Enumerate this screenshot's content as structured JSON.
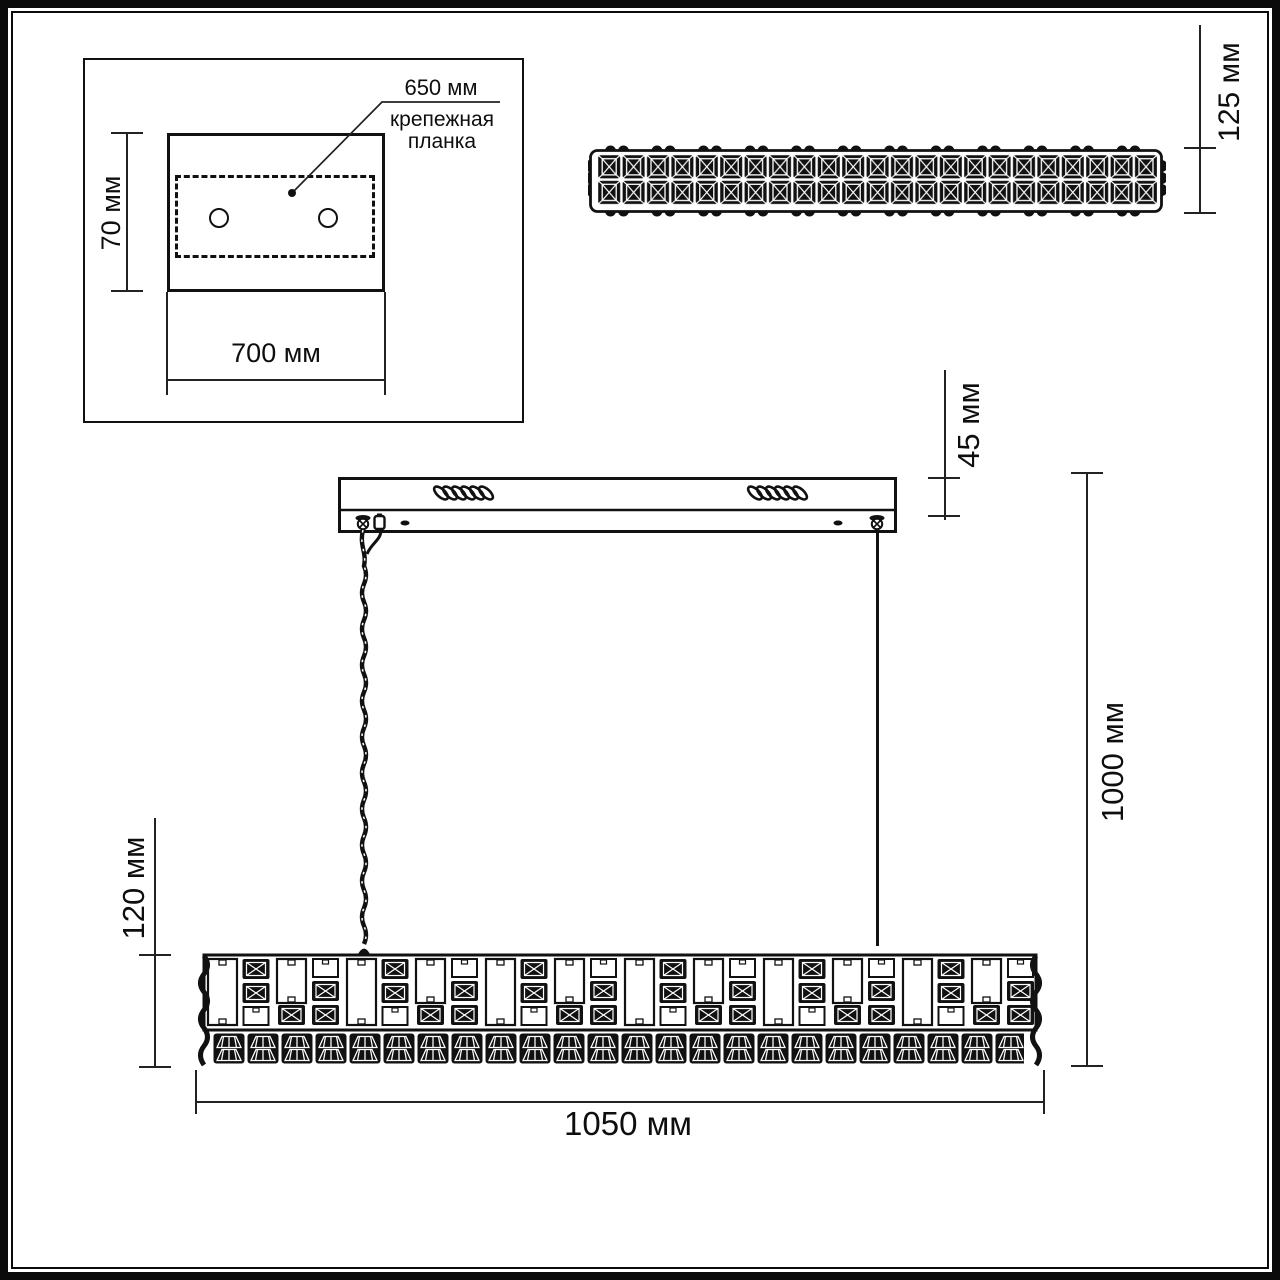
{
  "dimensions": {
    "inset_callout_value": "650 мм",
    "inset_callout_line1": "крепежная",
    "inset_callout_line2": "планка",
    "inset_height": "70 мм",
    "inset_width": "700 мм",
    "top_view_height": "125 мм",
    "canopy_height": "45 мм",
    "suspension_height": "1000 мм",
    "fixture_height": "120 мм",
    "fixture_length": "1050 мм"
  },
  "colors": {
    "line": "#111111",
    "background": "#ffffff"
  }
}
